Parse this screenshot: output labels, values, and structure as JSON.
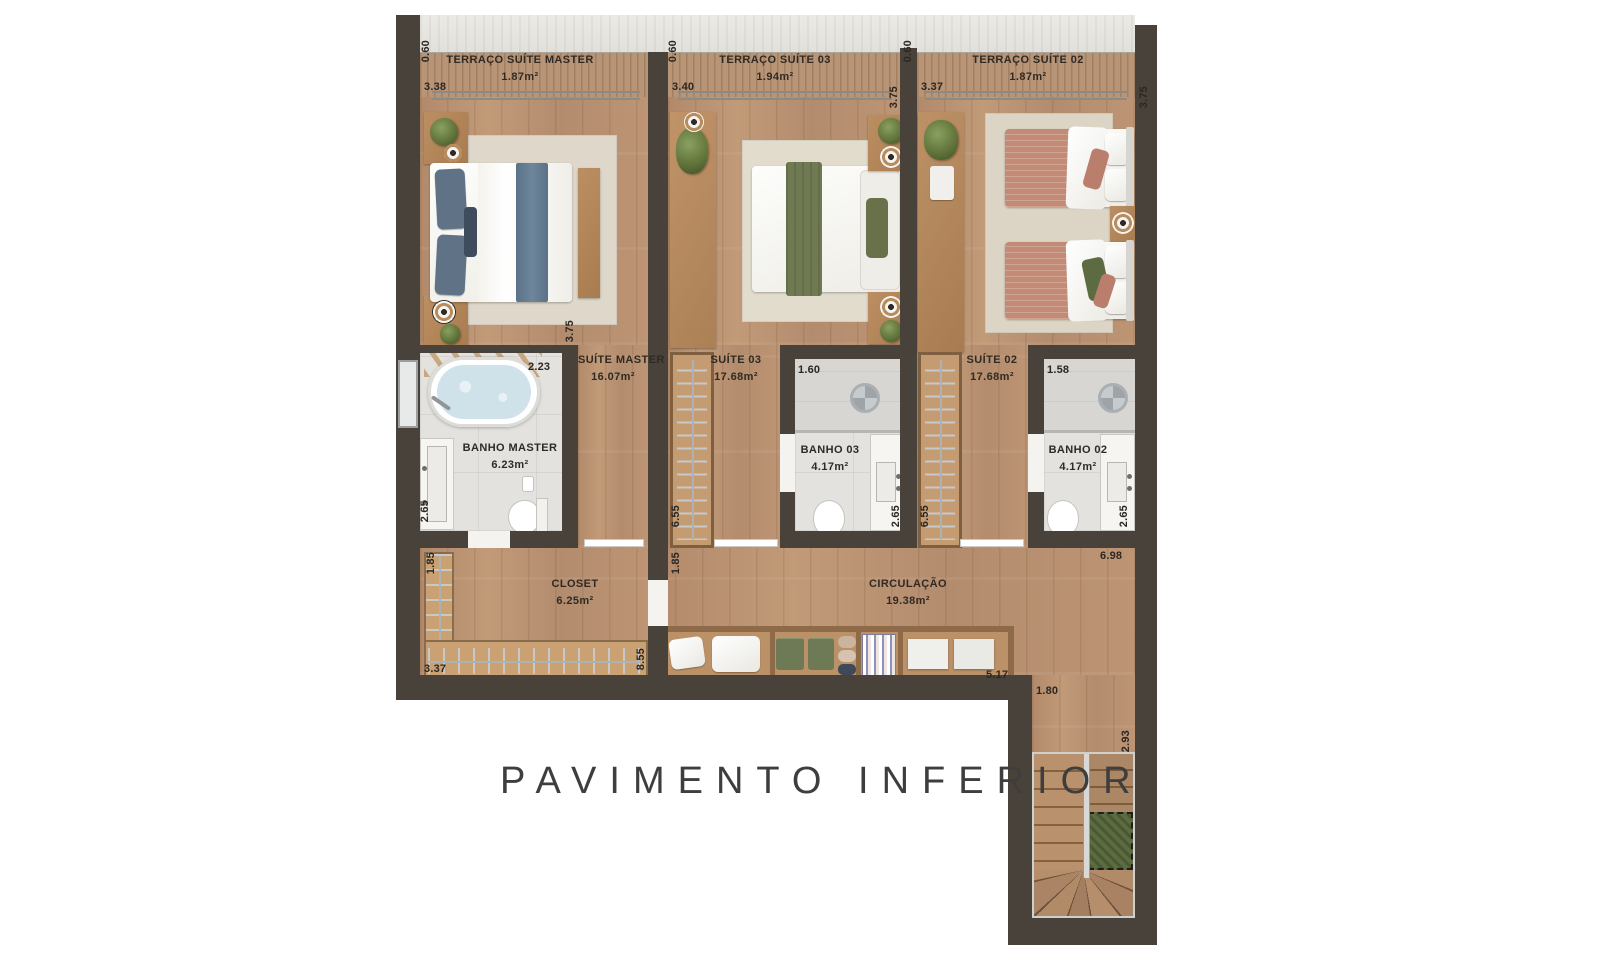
{
  "title": {
    "text": "PAVIMENTO INFERIOR"
  },
  "rooms": {
    "terraco_master": {
      "name": "TERRAÇO SUÍTE MASTER",
      "area": "1.87m²"
    },
    "terraco_03": {
      "name": "TERRAÇO SUÍTE 03",
      "area": "1.94m²"
    },
    "terraco_02": {
      "name": "TERRAÇO SUÍTE 02",
      "area": "1.87m²"
    },
    "suite_master": {
      "name": "SUÍTE MASTER",
      "area": "16.07m²"
    },
    "suite_03": {
      "name": "SUÍTE 03",
      "area": "17.68m²"
    },
    "suite_02": {
      "name": "SUÍTE 02",
      "area": "17.68m²"
    },
    "banho_master": {
      "name": "BANHO MASTER",
      "area": "6.23m²"
    },
    "banho_03": {
      "name": "BANHO 03",
      "area": "4.17m²"
    },
    "banho_02": {
      "name": "BANHO 02",
      "area": "4.17m²"
    },
    "closet": {
      "name": "CLOSET",
      "area": "6.25m²"
    },
    "circulacao": {
      "name": "CIRCULAÇÃO",
      "area": "19.38m²"
    }
  },
  "dims": {
    "terr_master_depth": "0.60",
    "terr_master_width": "3.38",
    "terr_03_depth": "0.60",
    "terr_03_width": "3.40",
    "terr_02_depth": "0.60",
    "terr_02_width": "3.37",
    "suite_03_right": "3.75",
    "terr_02_right": "3.75",
    "suite_master_corridor": "3.75",
    "banho_master_width": "2.23",
    "banho_master_left": "2.65",
    "closet_top_left": "1.85",
    "closet_width": "3.37",
    "closet_right": "8.55",
    "circ_left": "1.85",
    "banho_03_width": "1.60",
    "banho_03_right": "2.65",
    "corr_03_height": "6.55",
    "corr_02_height": "6.55",
    "banho_02_width": "1.58",
    "banho_02_right": "2.65",
    "circ_right": "6.98",
    "circ_bottom": "5.17",
    "stair_opening": "1.80",
    "stair_height": "2.93"
  },
  "colors": {
    "wall": "#49423b",
    "wood_floor": "#b98f71",
    "terrace_deck": "#b99577",
    "bath_tile": "#e3e2de",
    "accent_blue": "#647d92",
    "accent_green": "#6f7a52",
    "accent_terracotta": "#c38b76",
    "stair_void_green": "#5c6b40"
  }
}
